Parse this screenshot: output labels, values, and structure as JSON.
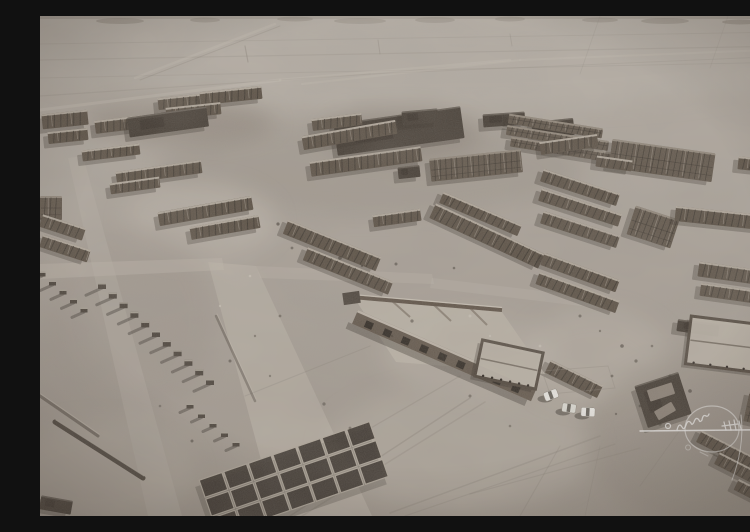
{
  "meta": {
    "description": "Sepia-toned aerial drone photograph of an abandoned ruined settlement on a flat desert plain: grid rows of roofless mud-brick building shells, dirt roads and tire tracks, three white SUVs parked among the ruins, and a white handwritten photographer signature watermark at the lower right. No legible text.",
    "photo_type": "aerial-oblique",
    "tone": "sepia-monochrome",
    "watermark": {
      "kind": "handwritten-signature",
      "legible": false,
      "color": "#ffffff",
      "position": "bottom-right"
    },
    "vehicle_count": 3
  },
  "palette": {
    "groundTop": "#b8b1a8",
    "groundMid": "#ada59c",
    "groundBot": "#a1988e",
    "horizonBand": "#8e877d",
    "hill": "#7d766c",
    "ruinRow": "#4f4438",
    "ruinCells": "#564b3f",
    "ruinDark": "#352d25",
    "ruinLight": "#d7cfc2",
    "shadow": "#201a15",
    "roadLight": "#c5bdb2",
    "trackLight": "#cfc7bc",
    "trackDark": "#6f675e",
    "courtyard": "#c1b9ad",
    "wall": "#372f27",
    "vehicle": "#f3f2ee",
    "vehicleAlt": "#e4e3dc",
    "glass": "#3a342d",
    "debrisDark": "#2e2720",
    "debrisLight": "#d9d2c6",
    "signature": "#ffffff"
  },
  "scene": {
    "width": 750,
    "height": 500,
    "hills": [
      [
        80,
        5,
        24,
        3
      ],
      [
        165,
        4,
        15,
        2.5
      ],
      [
        255,
        3,
        18,
        2.5
      ],
      [
        320,
        5,
        26,
        3
      ],
      [
        395,
        4,
        20,
        3
      ],
      [
        470,
        3,
        15,
        2.5
      ],
      [
        560,
        4,
        18,
        2.5
      ],
      [
        625,
        5,
        24,
        3
      ],
      [
        700,
        6,
        18,
        2.5
      ],
      [
        745,
        4,
        10,
        2
      ]
    ],
    "patches": [
      [
        380,
        48,
        390,
        46,
        "#beb7ae",
        0.55
      ],
      [
        330,
        152,
        210,
        48,
        "#958d83",
        0.4
      ],
      [
        160,
        205,
        75,
        38,
        "#c8c0b5",
        0.5
      ],
      [
        90,
        305,
        85,
        95,
        "#9b9289",
        0.4
      ],
      [
        60,
        458,
        95,
        52,
        "#b6aea3",
        0.5
      ],
      [
        420,
        432,
        135,
        62,
        "#bab2a7",
        0.5
      ],
      [
        555,
        342,
        75,
        48,
        "#c3bbb0",
        0.5
      ],
      [
        660,
        425,
        115,
        85,
        "#8f867c",
        0.45
      ],
      [
        140,
        106,
        95,
        22,
        "#6f6358",
        0.35
      ],
      [
        360,
        118,
        80,
        26,
        "#6f6358",
        0.3
      ],
      [
        430,
        338,
        90,
        40,
        "#c6beb3",
        0.4
      ]
    ],
    "tracks": [
      [
        0,
        28,
        750,
        16,
        1,
        "d",
        0.12
      ],
      [
        0,
        44,
        750,
        30,
        1.2,
        "d",
        0.15
      ],
      [
        0,
        62,
        750,
        46,
        1,
        "d",
        0.12
      ],
      [
        0,
        80,
        330,
        58,
        1.2,
        "d",
        0.15
      ],
      [
        330,
        58,
        750,
        40,
        1,
        "d",
        0.12
      ],
      [
        95,
        62,
        235,
        8,
        2.5,
        "l",
        0.4
      ],
      [
        100,
        64,
        240,
        10,
        1,
        "d",
        0.2
      ],
      [
        262,
        68,
        480,
        44,
        2,
        "l",
        0.3
      ],
      [
        480,
        44,
        750,
        33,
        2,
        "l",
        0.3
      ],
      [
        0,
        94,
        240,
        64,
        3,
        "l",
        0.4
      ],
      [
        240,
        64,
        470,
        44,
        2.5,
        "l",
        0.35
      ],
      [
        560,
        0,
        540,
        58,
        1,
        "d",
        0.12
      ],
      [
        688,
        0,
        670,
        52,
        1,
        "d",
        0.1
      ],
      [
        205,
        30,
        208,
        46,
        1.2,
        "d",
        0.3
      ],
      [
        338,
        24,
        340,
        38,
        1,
        "d",
        0.25
      ],
      [
        470,
        18,
        472,
        30,
        1,
        "d",
        0.2
      ],
      [
        250,
        500,
        430,
        382,
        1.5,
        "d",
        0.25
      ],
      [
        262,
        500,
        445,
        386,
        1.5,
        "d",
        0.2
      ],
      [
        350,
        497,
        560,
        420,
        1.5,
        "d",
        0.22
      ],
      [
        365,
        500,
        575,
        428,
        1.2,
        "d",
        0.18
      ],
      [
        430,
        478,
        600,
        432,
        1.2,
        "d",
        0.18
      ],
      [
        300,
        430,
        420,
        360,
        1.3,
        "d",
        0.2
      ],
      [
        205,
        380,
        330,
        330,
        1.2,
        "d",
        0.18
      ],
      [
        480,
        500,
        520,
        430,
        1.2,
        "d",
        0.18
      ],
      [
        545,
        500,
        560,
        430,
        1,
        "d",
        0.15
      ],
      [
        600,
        470,
        650,
        400,
        1,
        "d",
        0.15
      ]
    ],
    "roads": [
      [
        "168,246 216,250 332,500 236,500",
        0.5
      ],
      [
        "0,248 182,242 184,254 0,263",
        0.45
      ],
      [
        "28,142 43,140 142,500 108,500",
        0.3
      ],
      [
        "216,250 392,258 394,268 220,262",
        0.35
      ],
      [
        "392,262 560,282 558,292 390,272",
        0.3
      ]
    ],
    "blocks": [
      [
        2,
        96,
        46,
        15,
        -6,
        "r"
      ],
      [
        8,
        114,
        40,
        12,
        -6,
        "r"
      ],
      [
        55,
        102,
        48,
        13,
        -7,
        "r"
      ],
      [
        118,
        80,
        42,
        12,
        -6,
        "r"
      ],
      [
        160,
        73,
        62,
        13,
        -6,
        "r"
      ],
      [
        126,
        89,
        55,
        12,
        -6,
        "r"
      ],
      [
        88,
        96,
        80,
        20,
        -8,
        "d"
      ],
      [
        295,
        99,
        128,
        32,
        -8,
        "d"
      ],
      [
        492,
        104,
        42,
        17,
        -6,
        "d"
      ],
      [
        272,
        100,
        50,
        12,
        -7,
        "r"
      ],
      [
        362,
        94,
        36,
        14,
        -5,
        "d"
      ],
      [
        443,
        97,
        42,
        13,
        -4,
        "d"
      ],
      [
        468,
        105,
        95,
        10,
        9,
        "c"
      ],
      [
        466,
        117,
        103,
        10,
        9,
        "c"
      ],
      [
        470,
        129,
        108,
        10,
        9,
        "c"
      ],
      [
        580,
        134,
        26,
        11,
        9,
        "d"
      ],
      [
        42,
        131,
        58,
        11,
        -7,
        "r"
      ],
      [
        76,
        150,
        86,
        13,
        -8,
        "r"
      ],
      [
        70,
        164,
        50,
        11,
        -8,
        "r"
      ],
      [
        0,
        180,
        22,
        24,
        0,
        "c"
      ],
      [
        0,
        205,
        45,
        13,
        18,
        "r"
      ],
      [
        0,
        226,
        50,
        13,
        18,
        "r"
      ],
      [
        118,
        188,
        95,
        14,
        -10,
        "r"
      ],
      [
        150,
        205,
        70,
        13,
        -10,
        "r"
      ],
      [
        262,
        112,
        95,
        14,
        -10,
        "r"
      ],
      [
        270,
        138,
        112,
        15,
        -8,
        "r"
      ],
      [
        390,
        138,
        92,
        23,
        -6,
        "c"
      ],
      [
        358,
        150,
        22,
        12,
        -6,
        "d"
      ],
      [
        570,
        130,
        104,
        29,
        8,
        "c"
      ],
      [
        500,
        122,
        58,
        13,
        -8,
        "r"
      ],
      [
        556,
        142,
        36,
        11,
        8,
        "r"
      ],
      [
        698,
        143,
        54,
        13,
        6,
        "r"
      ],
      [
        500,
        165,
        80,
        13,
        18,
        "r"
      ],
      [
        498,
        185,
        84,
        13,
        18,
        "r"
      ],
      [
        590,
        196,
        46,
        30,
        18,
        "c"
      ],
      [
        635,
        196,
        115,
        15,
        6,
        "r"
      ],
      [
        500,
        207,
        80,
        13,
        18,
        "r"
      ],
      [
        333,
        196,
        48,
        12,
        -8,
        "r"
      ],
      [
        398,
        192,
        85,
        12,
        23,
        "r"
      ],
      [
        387,
        212,
        120,
        16,
        25,
        "r"
      ],
      [
        500,
        250,
        80,
        13,
        20,
        "r"
      ],
      [
        495,
        270,
        85,
        13,
        20,
        "r"
      ],
      [
        658,
        252,
        95,
        15,
        8,
        "r"
      ],
      [
        660,
        272,
        75,
        13,
        8,
        "r"
      ],
      [
        242,
        222,
        100,
        15,
        22,
        "r"
      ],
      [
        262,
        248,
        92,
        14,
        22,
        "r"
      ],
      [
        505,
        356,
        58,
        14,
        26,
        "r"
      ],
      [
        655,
        430,
        72,
        13,
        27,
        "r"
      ],
      [
        673,
        452,
        72,
        13,
        27,
        "r"
      ],
      [
        693,
        476,
        60,
        12,
        27,
        "r"
      ],
      [
        706,
        380,
        44,
        30,
        12,
        "c"
      ],
      [
        637,
        306,
        42,
        12,
        8,
        "d"
      ],
      [
        0,
        482,
        32,
        14,
        10,
        "d"
      ],
      [
        600,
        362,
        46,
        44,
        -18,
        "d"
      ]
    ],
    "lightBits": [
      [
        608,
        370,
        26,
        12,
        -18
      ],
      [
        615,
        390,
        20,
        10,
        -30
      ]
    ],
    "walls": [
      [
        15,
        406,
        103,
        462,
        5,
        0.9
      ],
      [
        0,
        380,
        58,
        420,
        3,
        0.5
      ],
      [
        176,
        300,
        215,
        385,
        2.5,
        0.4
      ]
    ],
    "stubRows": [
      [
        62,
        270,
        170,
        366,
        11,
        8,
        6,
        16
      ],
      [
        2,
        258,
        44,
        294,
        5,
        7,
        5,
        12
      ],
      [
        150,
        390,
        196,
        428,
        5,
        7,
        5,
        10
      ]
    ],
    "compound": {
      "courtyard": "315,283 462,296 505,358 356,346",
      "backWall": [
        312,
        281,
        462,
        294
      ],
      "crossWalls": [
        [
          352,
          285,
          370,
          301
        ],
        [
          394,
          289,
          411,
          305
        ],
        [
          430,
          292,
          447,
          309
        ]
      ],
      "facade": {
        "x": 318,
        "y": 294,
        "len": 195,
        "h": 15,
        "rot": 23.4,
        "windows": 9
      },
      "leftEnd": [
        303,
        276,
        17,
        12,
        -8
      ]
    },
    "courts": [
      {
        "x": 438,
        "y": 330,
        "w": 62,
        "h": 37,
        "rot": 12
      },
      {
        "x": 648,
        "y": 306,
        "w": 100,
        "h": 48,
        "rot": 7
      }
    ],
    "cellClusters": [
      {
        "cx": 255,
        "cy": 463,
        "rot": -19,
        "rows": 3,
        "cols": 7,
        "cw": 24,
        "ch": 18,
        "gap": 2
      }
    ],
    "faintTraces": [
      [
        "502,355 568,350 575,372 510,378",
        0.35
      ]
    ],
    "debrisDark": [
      [
        238,
        208,
        1.6,
        0.6
      ],
      [
        252,
        232,
        1.4,
        0.5
      ],
      [
        300,
        242,
        1.8,
        0.6
      ],
      [
        322,
        250,
        1.2,
        0.5
      ],
      [
        356,
        248,
        1.5,
        0.55
      ],
      [
        414,
        252,
        1.3,
        0.5
      ],
      [
        372,
        305,
        1.6,
        0.5
      ],
      [
        352,
        320,
        1.2,
        0.45
      ],
      [
        540,
        300,
        1.5,
        0.5
      ],
      [
        560,
        315,
        1.2,
        0.45
      ],
      [
        582,
        330,
        1.8,
        0.55
      ],
      [
        572,
        360,
        1.4,
        0.5
      ],
      [
        596,
        345,
        1.6,
        0.5
      ],
      [
        612,
        330,
        1.3,
        0.45
      ],
      [
        630,
        360,
        1.5,
        0.5
      ],
      [
        650,
        375,
        1.8,
        0.55
      ],
      [
        600,
        390,
        1.4,
        0.5
      ],
      [
        576,
        398,
        1.2,
        0.45
      ],
      [
        620,
        408,
        1.6,
        0.5
      ],
      [
        240,
        300,
        1.4,
        0.45
      ],
      [
        215,
        320,
        1.2,
        0.4
      ],
      [
        190,
        345,
        1.5,
        0.5
      ],
      [
        230,
        360,
        1.2,
        0.4
      ],
      [
        284,
        388,
        1.6,
        0.5
      ],
      [
        310,
        412,
        1.4,
        0.45
      ],
      [
        402,
        340,
        1.3,
        0.4
      ],
      [
        430,
        380,
        1.5,
        0.45
      ],
      [
        470,
        410,
        1.3,
        0.4
      ],
      [
        152,
        425,
        1.5,
        0.5
      ],
      [
        120,
        390,
        1.3,
        0.4
      ]
    ],
    "debrisLight": [
      [
        430,
        300,
        1.5
      ],
      [
        450,
        320,
        1.2
      ],
      [
        500,
        330,
        1.4
      ],
      [
        210,
        260,
        1.3
      ],
      [
        180,
        290,
        1.2
      ]
    ],
    "vehicles": [
      [
        511,
        379,
        -20
      ],
      [
        529,
        392,
        8
      ],
      [
        548,
        396,
        3
      ]
    ],
    "signature": {
      "baseline": [
        600,
        415,
        747,
        413.5
      ],
      "startDot": [
        628,
        410,
        2.5
      ],
      "script": "M637,414 q2,-8 5,-3 q2,4 4,-2 q2,-6 5,-2 q1,3 3,-1 q2,-6 5,-2 q1,3 3,0 q1,-6 4,-4 q2,1 3,-2",
      "loop": [
        672,
        413,
        27,
        23
      ],
      "chop": "M684,406 l2,8 m3,-9 l2,9 m3,-10 l2,10 m3,-9 l2,8 M682,410 l16,-2",
      "descender": "M701,399 C704,422 699,446 692,464",
      "belowMarks": "M648,429 a2.5,2.5 0 1 0 0.1,0 M660,436 l8,4"
    }
  }
}
